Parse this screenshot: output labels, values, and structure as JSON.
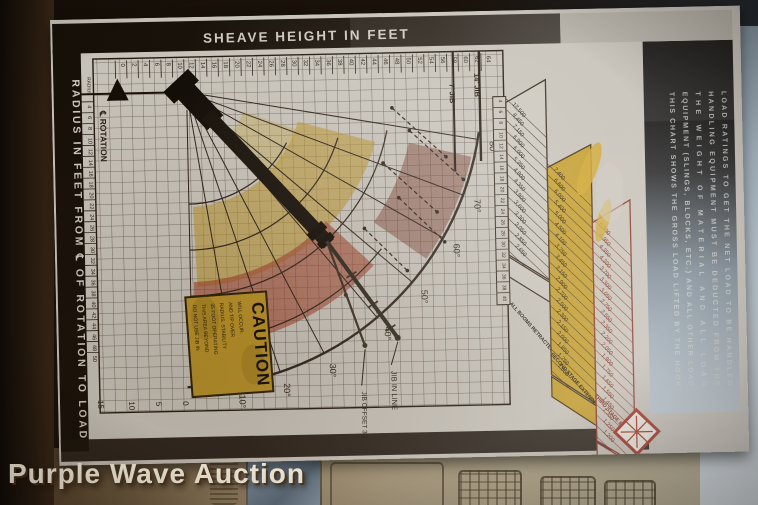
{
  "photo": {
    "watermark": "Purple Wave Auction"
  },
  "placard": {
    "top_axis": {
      "title": "SHEAVE HEIGHT IN FEET",
      "ticks": [
        "0",
        "2",
        "4",
        "6",
        "8",
        "10",
        "12",
        "14",
        "16",
        "18",
        "20",
        "22",
        "24",
        "26",
        "28",
        "30",
        "32",
        "34",
        "36",
        "38",
        "40",
        "42",
        "44",
        "46",
        "48",
        "50",
        "52",
        "54",
        "56",
        "58",
        "60",
        "62",
        "64"
      ],
      "jib_labels": [
        "7' JIB",
        "14' JIB"
      ]
    },
    "left_axis": {
      "title": "RADIUS IN FEET FROM ℄ OF ROTATION TO LOAD",
      "header": "RADIUS",
      "ticks": [
        "4",
        "6",
        "8",
        "10",
        "12",
        "14",
        "16",
        "18",
        "20",
        "22",
        "24",
        "26",
        "28",
        "30",
        "32",
        "34",
        "36",
        "38",
        "40",
        "42",
        "44",
        "46",
        "48",
        "50"
      ]
    },
    "rotation_label": "℄ ROTATION",
    "angle_labels": [
      "80°",
      "70°",
      "60°",
      "50°",
      "40°",
      "30°",
      "20°",
      "10°"
    ],
    "bottom_scale": [
      "15",
      "10",
      "5",
      "0"
    ],
    "jib_in_line_label": "JIB IN LINE",
    "jib_offset_label": "JIB OFFSET 30°",
    "caution": {
      "title": "CAUTION",
      "lines": [
        "DO NOT USE JIB IN",
        "THIS AREA BEYOND",
        "35 FOOT OPERATING",
        "RADIUS. STABILITY",
        "AND TIP OVER",
        "WILL OCCUR."
      ]
    },
    "load_table": {
      "radius_header": "RADIUS",
      "radii": [
        "4",
        "6",
        "8",
        "10",
        "12",
        "14",
        "16",
        "18",
        "20",
        "22",
        "24",
        "26",
        "28",
        "30",
        "32",
        "34",
        "36",
        "38",
        "40"
      ],
      "columns": [
        {
          "label": "ALL BOOMS RETRACTED",
          "values": [
            "12,500",
            "8,450",
            "7,150",
            "6,900",
            "6,000",
            "5,350",
            "4,800",
            "4,350",
            "3,900",
            "3,600",
            "3,300",
            "3,050",
            "2,850",
            "2,650"
          ]
        },
        {
          "label": "SECOND STAGE EXTENDED",
          "values": [
            "7,400",
            "6,600",
            "6,000",
            "5,400",
            "5,000",
            "4,500",
            "4,100",
            "3,750",
            "3,450",
            "3,150",
            "2,900",
            "2,700",
            "2,500",
            "2,300",
            "2,150",
            "2,000",
            "1,850",
            "1,750",
            "1,650"
          ]
        },
        {
          "label": "THIRD STAGE EXTENDED",
          "values": [
            "5,800",
            "4,950",
            "4,350",
            "4,200",
            "3,700",
            "3,300",
            "3,050",
            "2,750",
            "2,550",
            "2,350",
            "2,200",
            "2,050",
            "1,900",
            "1,750",
            "1,650",
            "1,550",
            "1,450",
            "1,350",
            "1,250",
            "1,200"
          ]
        }
      ]
    },
    "notes": [
      "THIS CHART SHOWS THE GROSS LOAD LIFTED BY THE HOOK",
      "EQUIPMENT (SLINGS, BLOCKS, ETC.) AND ALL OTHER LOAD",
      "THE WEIGHT OF MATERIAL AND ALL LOAD",
      "HANDLING EQUIPMENT MUST BE DEDUCTED FROM THE",
      "LOAD RATINGS TO GET THE NET LOAD TO BE HANDLED"
    ]
  },
  "chart_data": {
    "type": "table",
    "title": "Crane boom range diagram with load rating table (photographed placard)",
    "x_axis": {
      "label": "SHEAVE HEIGHT IN FEET",
      "range": [
        0,
        64
      ],
      "step": 2
    },
    "y_axis": {
      "label": "RADIUS IN FEET FROM ℄ OF ROTATION TO LOAD",
      "range": [
        4,
        50
      ],
      "step": 2
    },
    "boom_angle_lines_deg": [
      0,
      10,
      20,
      30,
      40,
      50,
      60,
      70,
      80
    ],
    "annotations": [
      "JIB IN LINE",
      "JIB OFFSET 30°",
      "7' JIB",
      "14' JIB",
      "℄ ROTATION",
      "CAUTION"
    ],
    "categories_radius_ft": [
      4,
      6,
      8,
      10,
      12,
      14,
      16,
      18,
      20,
      22,
      24,
      26,
      28,
      30,
      32,
      34,
      36,
      38,
      40
    ],
    "series": [
      {
        "name": "ALL BOOMS RETRACTED",
        "start_radius_ft": 4,
        "values_lbs": [
          12500,
          8450,
          7150,
          6900,
          6000,
          5350,
          4800,
          4350,
          3900,
          3600,
          3300,
          3050,
          2850,
          2650
        ]
      },
      {
        "name": "SECOND STAGE EXTENDED",
        "start_radius_ft": 10,
        "values_lbs": [
          7400,
          6600,
          6000,
          5400,
          5000,
          4500,
          4100,
          3750,
          3450,
          3150,
          2900,
          2700,
          2500,
          2300,
          2150,
          2000,
          1850,
          1750,
          1650
        ]
      },
      {
        "name": "THIRD STAGE EXTENDED",
        "start_radius_ft": 14,
        "values_lbs": [
          5800,
          4950,
          4350,
          4200,
          3700,
          3300,
          3050,
          2750,
          2550,
          2350,
          2200,
          2050,
          1900,
          1750,
          1650,
          1550,
          1450,
          1350,
          1250,
          1200
        ]
      }
    ],
    "legend_position": "bottom of each slanted column",
    "grid": true
  }
}
